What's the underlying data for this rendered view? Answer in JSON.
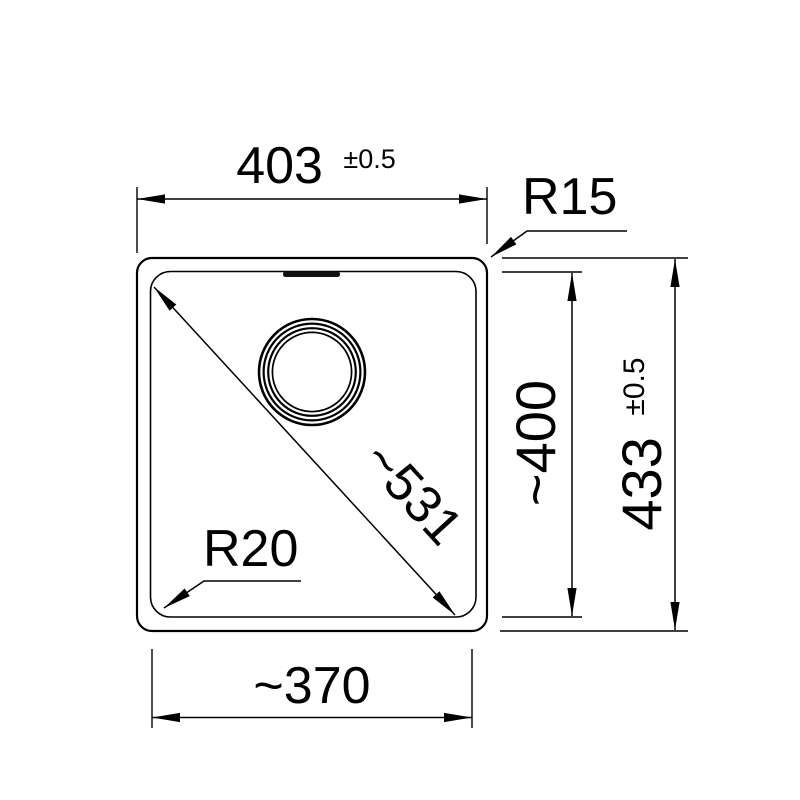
{
  "drawing": {
    "type": "technical dimension drawing",
    "subject": "sink bowl top view",
    "colors": {
      "line": "#000000",
      "background": "#ffffff"
    },
    "labels": {
      "width_overall": {
        "value": "403",
        "tolerance": "±0.5"
      },
      "corner_radius_outer": "R15",
      "height_overall": {
        "value": "433",
        "tolerance": "±0.5"
      },
      "depth_inner": "~400",
      "diagonal": "~531",
      "corner_radius_inner": "R20",
      "width_inner": "~370"
    }
  }
}
